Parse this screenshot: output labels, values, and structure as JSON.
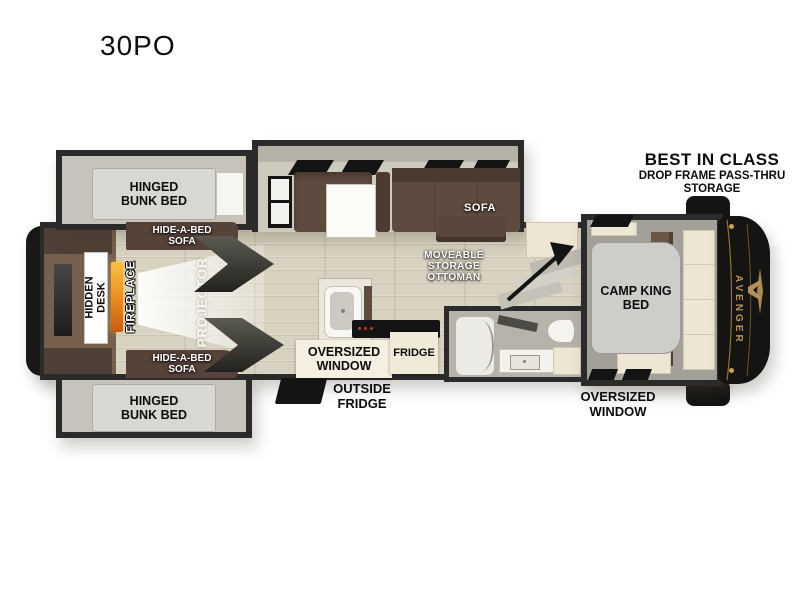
{
  "model": "30PO",
  "callout": {
    "title": "BEST IN CLASS",
    "subtitle": "DROP FRAME PASS-THRU\nSTORAGE"
  },
  "brand": {
    "wordmark": "AVENGER",
    "accent_gold": "#b3925a",
    "cap_black": "#151413"
  },
  "labels": {
    "bunk_top": "HINGED\nBUNK BED",
    "bunk_bottom": "HINGED\nBUNK BED",
    "hide_a_bed_top": "HIDE-A-BED\nSOFA",
    "hide_a_bed_bottom": "HIDE-A-BED\nSOFA",
    "hidden_desk": "HIDDEN\nDESK",
    "fireplace": "FIREPLACE",
    "projector": "PROJECTOR",
    "sofa": "SOFA",
    "ottoman": "MOVEABLE\nSTORAGE\nOTTOMAN",
    "kitchen_window": "OVERSIZED\nWINDOW",
    "fridge": "FRIDGE",
    "outside_fridge": "OUTSIDE\nFRIDGE",
    "camp_king_bed": "CAMP KING\nBED",
    "bedroom_window": "OVERSIZED\nWINDOW"
  },
  "colors": {
    "wall": "#2b2b2b",
    "floor": "#d8d2c1",
    "sofa_brown": "#5e4b3f",
    "cabinet_brown": "#6b5748",
    "cream": "#ece6d3",
    "bed_gray": "#cecdc9",
    "label_box": "#f4efe1"
  }
}
